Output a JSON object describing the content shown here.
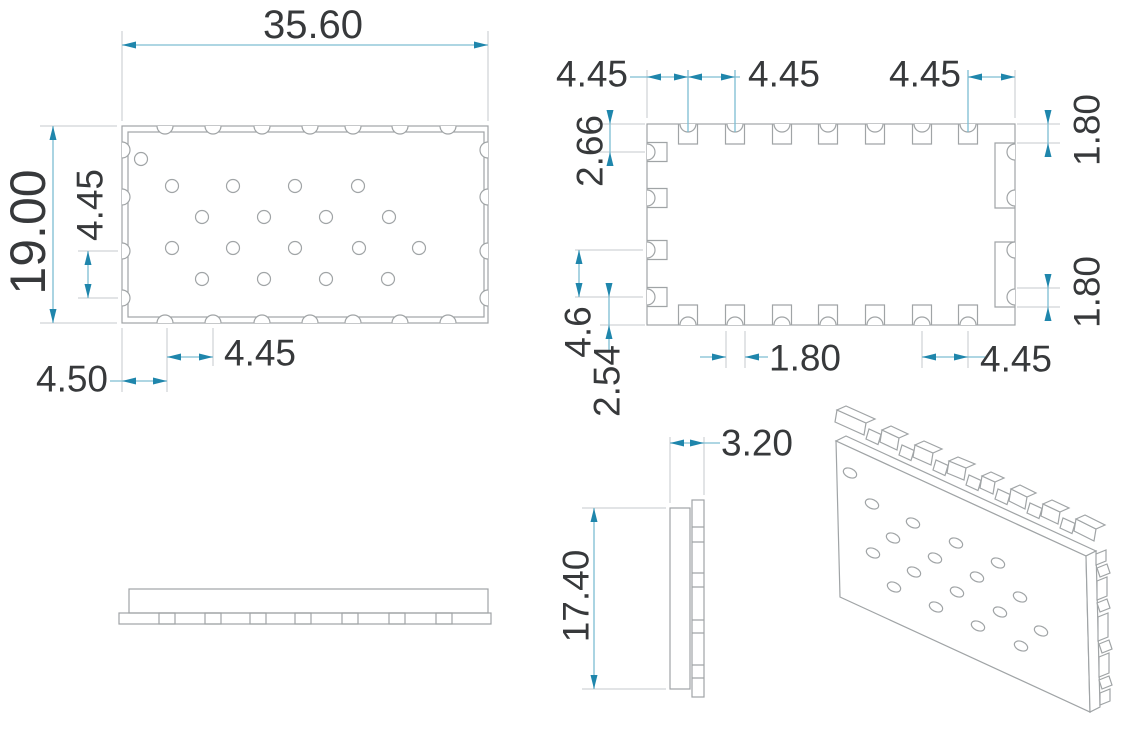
{
  "drawing": {
    "title": "Castellated module package dimension drawing",
    "units": "mm",
    "colors": {
      "outline": "#a0a4a6",
      "dimension_line": "#7dbdd2",
      "arrow": "#1f86ac",
      "extension_line": "#c6cacc",
      "text": "#37393b",
      "background": "#ffffff"
    },
    "views": {
      "top_view": {
        "name": "Top view",
        "dims": {
          "overall_width": "35.60",
          "overall_height": "19.00",
          "side_castellation_pitch": "4.45",
          "bottom_castellation_pitch": "4.45",
          "edge_to_first_castellation": "4.50"
        }
      },
      "bottom_view": {
        "name": "Bottom view",
        "dims": {
          "edge_to_first_pad": "4.45",
          "top_pad_pitch": "4.45",
          "last_pad_to_edge": "4.45",
          "top_edge_to_side_pad": "2.66",
          "right_pad_top": "1.80",
          "right_pad_bottom": "1.80",
          "side_pad_pitch": "4.6",
          "side_pad_to_bottom_edge": "2.54",
          "bottom_pad_width": "1.80",
          "bottom_pad_pitch": "4.45"
        }
      },
      "side_view": {
        "name": "Side view"
      },
      "end_view": {
        "name": "End view",
        "dims": {
          "thickness": "3.20",
          "height": "17.40"
        }
      },
      "iso_view": {
        "name": "Isometric view"
      }
    }
  }
}
